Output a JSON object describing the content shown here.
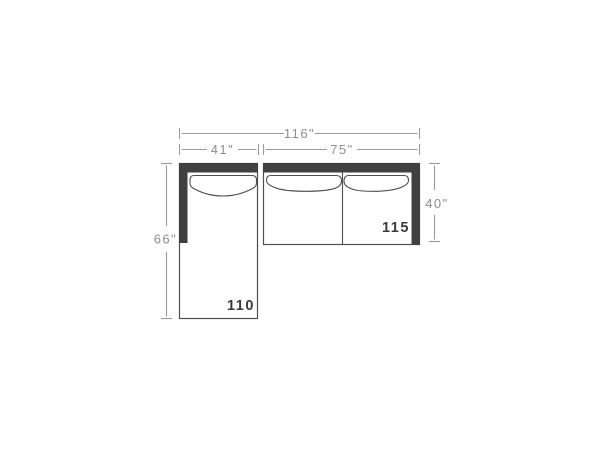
{
  "diagram": {
    "dimensions": {
      "total_width": "116\"",
      "chaise_width": "41\"",
      "sofa_width": "75\"",
      "chaise_depth": "66\"",
      "sofa_depth": "40\""
    },
    "units": {
      "chaise_label": "110",
      "sofa_label": "115"
    },
    "colors": {
      "background": "#ffffff",
      "frame_dark": "#404040",
      "outline": "#4f4f4f",
      "dimension_line": "#9a9a9a",
      "dimension_text": "#8e8e8e",
      "unit_label_text": "#3a3a3a"
    }
  }
}
